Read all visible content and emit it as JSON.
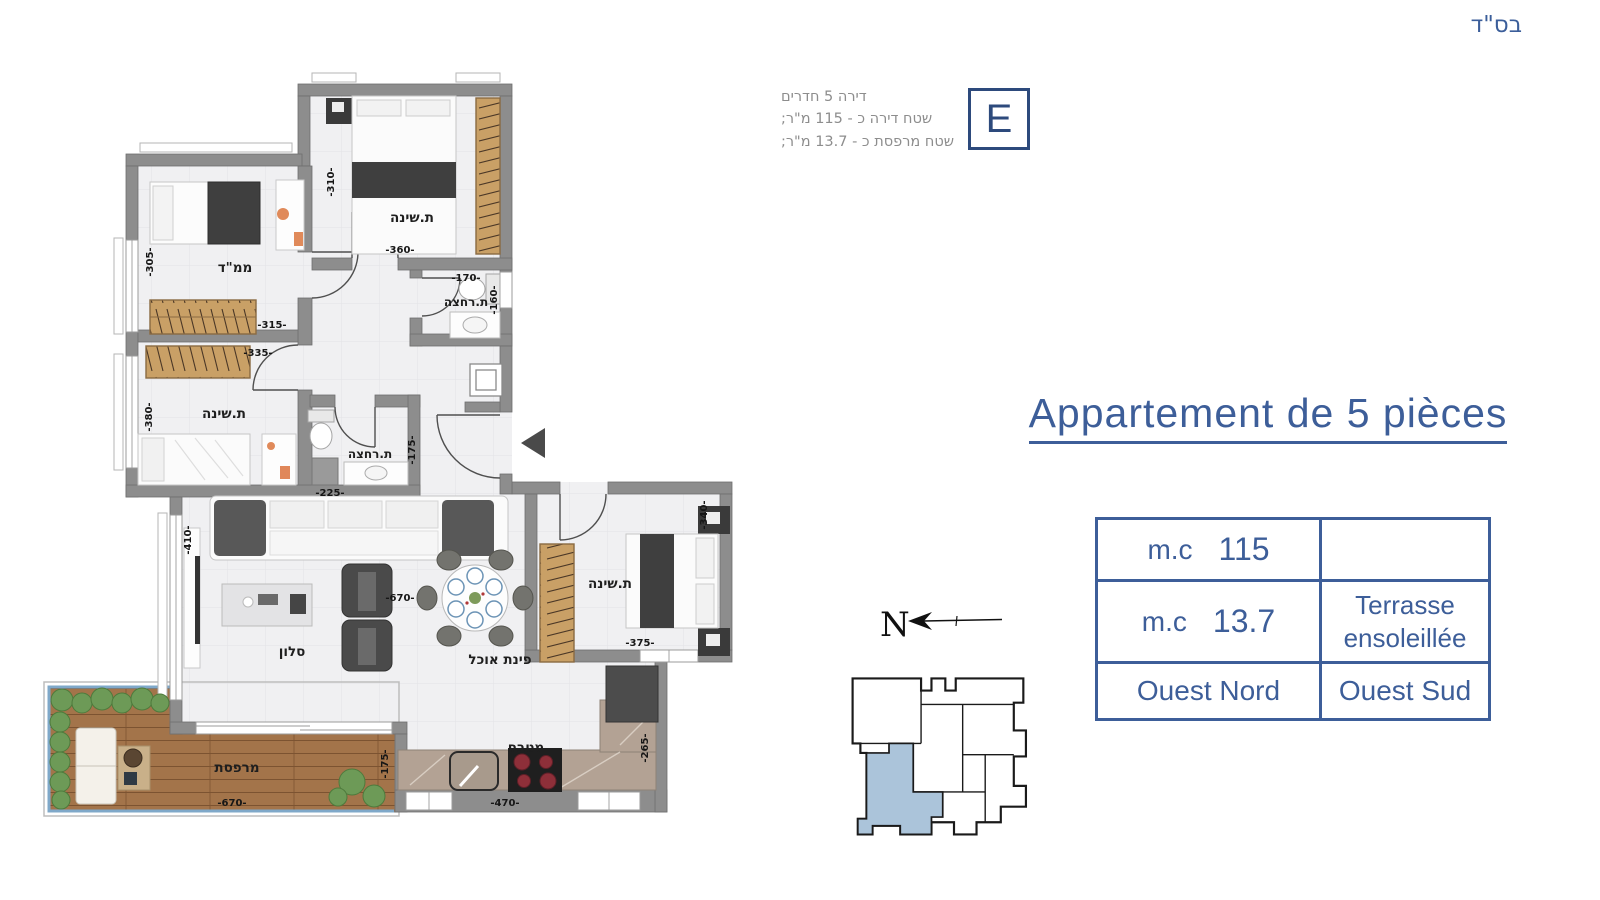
{
  "page": {
    "bsd": "בס\"ד"
  },
  "apartment_info": {
    "badge": "E",
    "line1": "דירה 5 חדרים",
    "line2": "שטח דירה כ - 115 מ\"ר;",
    "line3": "שטח מרפסת כ - 13.7 מ\"ר;"
  },
  "title": "Appartement de 5 pièces",
  "details_table": {
    "r1c1_unit": "m.c",
    "r1c1_value": "115",
    "r1c2": "",
    "r2c1_unit": "m.c",
    "r2c1_value": "13.7",
    "r2c2_line1": "Terrasse",
    "r2c2_line2": "ensoleillée",
    "r3c1": "Ouest Nord",
    "r3c2": "Ouest Sud"
  },
  "compass": {
    "north_label": "N"
  },
  "floor_plan": {
    "rooms": {
      "mamad": "ממ\"ד",
      "bedroom_top": "ת.שינה",
      "bathroom_top": "ת.רחצה",
      "bedroom_left": "ת.שינה",
      "bathroom_mid": "ת.רחצה",
      "salon": "סלון",
      "dining": "פינת אוכל",
      "bedroom_right": "ת.שינה",
      "kitchen": "מטבח",
      "terrace": "מרפסת"
    },
    "dims": {
      "mamad_left": "-305-",
      "mamad_bottom": "-315-",
      "bedroom_top_left": "-310-",
      "bedroom_top_bottom": "-360-",
      "bathroom_top_top": "-170-",
      "bathroom_top_right": "-160-",
      "bedroom_left_left": "-380-",
      "bedroom_left_top": "-335-",
      "bathroom_mid_bottom": "-225-",
      "bathroom_mid_right": "-175-",
      "salon_left": "-410-",
      "salon_width": "-670-",
      "bedroom_right_right": "-340-",
      "bedroom_right_bottom": "-375-",
      "kitchen_bottom": "-470-",
      "kitchen_right": "-265-",
      "terrace_bottom": "-670-",
      "terrace_right": "-175-"
    }
  },
  "colors": {
    "accent": "#3d5e99",
    "badge_blue": "#2d4a7c",
    "wall_gray": "#8d8d8d",
    "floor": "#f0f0f2",
    "keyplan_highlight": "#abc4da",
    "deck_wood": "#a3744a",
    "closet_wood": "#c9a066",
    "info_text": "#8d8d8d"
  }
}
